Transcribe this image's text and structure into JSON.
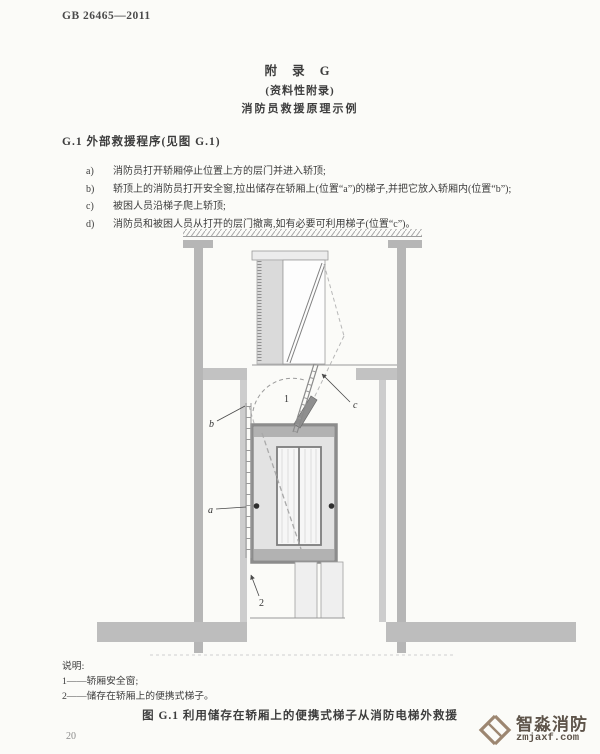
{
  "doc_header": {
    "standard_no": "GB 26465—2011"
  },
  "appendix": {
    "title": "附  录  G",
    "subtitle": "(资料性附录)",
    "subject": "消防员救援原理示例"
  },
  "section": {
    "heading": "G.1  外部救援程序(见图 G.1)"
  },
  "procedure": {
    "items": [
      {
        "marker": "a)",
        "text": "消防员打开轿厢停止位置上方的层门并进入轿顶;"
      },
      {
        "marker": "b)",
        "text": "轿顶上的消防员打开安全窗,拉出储存在轿厢上(位置“a”)的梯子,并把它放入轿厢内(位置“b”);"
      },
      {
        "marker": "c)",
        "text": "被困人员沿梯子爬上轿顶;"
      },
      {
        "marker": "d)",
        "text": "消防员和被困人员从打开的层门撤离,如有必要可利用梯子(位置“c”)。"
      }
    ]
  },
  "figure": {
    "labels": {
      "safety_window": "1",
      "stored_ladder": "2",
      "pos_a": "a",
      "pos_b": "b",
      "pos_c": "c"
    },
    "legend": {
      "title": "说明:",
      "item1": "1——轿厢安全窗;",
      "item2": "2——储存在轿厢上的便携式梯子。"
    },
    "caption": "图 G.1  利用储存在轿厢上的便携式梯子从消防电梯外救援"
  },
  "page": {
    "number": "20"
  },
  "watermark": {
    "brand": "智淼消防",
    "domain": "zmjaxf.com"
  },
  "colors": {
    "wall_gray": "#b6b6b6",
    "slab_gray": "#bdbdbd",
    "car_frame": "#8c8c8c",
    "watermark_brown": "#9c8671"
  }
}
